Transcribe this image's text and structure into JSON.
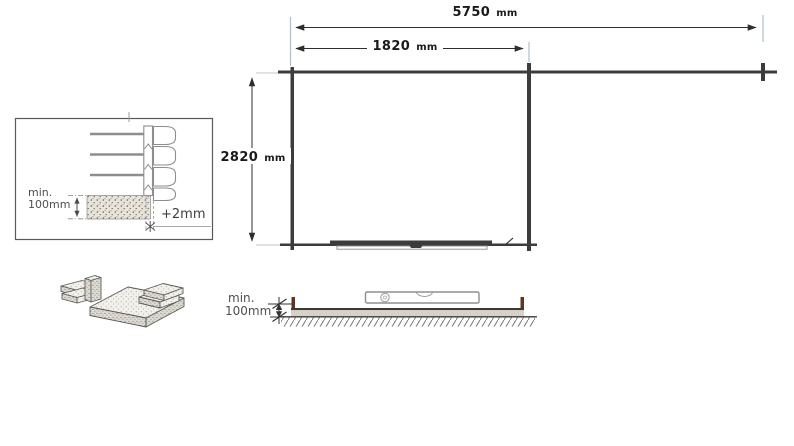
{
  "diagram": {
    "type": "shed-foundation-installation-plan",
    "plan_view": {
      "dim_total_width": {
        "value": "5750",
        "unit": "mm"
      },
      "dim_door_section_width": {
        "value": "1820",
        "unit": "mm"
      },
      "dim_depth": {
        "value": "2820",
        "unit": "mm"
      }
    },
    "inset_detail": {
      "min_height_label_line1": "min.",
      "min_height_label_line2": "100mm",
      "expansion_gap_label": "+2mm"
    },
    "side_view": {
      "min_height_label_line1": "min.",
      "min_height_label_line2": "100mm"
    },
    "illustrations": {
      "corner_detail": "log-wall-corner-on-foundation-beam",
      "side_view": "spirit-level-on-foundation-slab",
      "materials": "concrete-slab-and-bricks-isometric"
    },
    "colors": {
      "line_dark": "#3a3a3a",
      "detail_line_gray": "#8e8e8e",
      "extension_line_blue": "#a9bfd2",
      "extension_line_gray": "#c4c4c4",
      "text_dark": "#1a1a1a",
      "text_gray": "#4f4f4f",
      "slab_fill": "#d7d2c8",
      "peg_brown": "#5d3723"
    }
  }
}
